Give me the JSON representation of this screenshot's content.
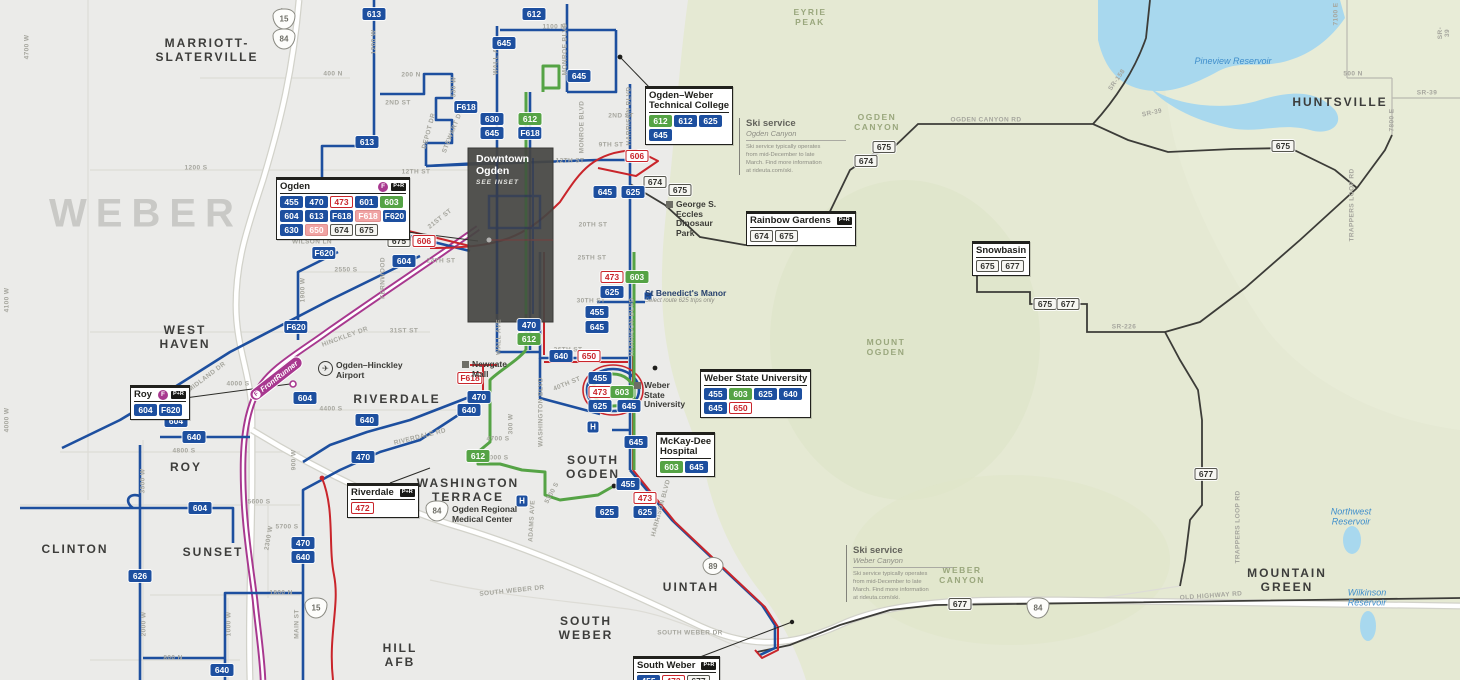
{
  "map_title": "UTA Ogden area bus routes map",
  "colors": {
    "route_blue": "#1d4f9f",
    "route_green": "#55a345",
    "route_red": "#c9252b",
    "route_pink": "#f0a3a3",
    "mountain_road": "#3c3c38",
    "frontrunner": "#a8388f",
    "terrain_green": "#e6ead5",
    "water": "#a8d8ee",
    "urban": "#ebebe9"
  },
  "inset": {
    "title": "Downtown\nOgden",
    "note": "SEE INSET"
  },
  "area_labels": [
    [
      "MARRIOTT-\nSLATERVILLE",
      207,
      51
    ],
    [
      "WEST\nHAVEN",
      185,
      338
    ],
    [
      "RIVERDALE",
      397,
      400
    ],
    [
      "ROY",
      186,
      468
    ],
    [
      "CLINTON",
      75,
      550
    ],
    [
      "SUNSET",
      213,
      553
    ],
    [
      "WASHINGTON\nTERRACE",
      468,
      491
    ],
    [
      "SOUTH\nOGDEN",
      593,
      468
    ],
    [
      "UINTAH",
      691,
      588
    ],
    [
      "SOUTH\nWEBER",
      586,
      629
    ],
    [
      "HILL\nAFB",
      400,
      656
    ],
    [
      "HUNTSVILLE",
      1340,
      103
    ],
    [
      "MOUNTAIN\nGREEN",
      1287,
      581
    ]
  ],
  "county_label": [
    "WEBER",
    146,
    214
  ],
  "green_area_labels": [
    [
      "EYRIE\nPEAK",
      810,
      17
    ],
    [
      "OGDEN\nCANYON",
      877,
      122
    ],
    [
      "MOUNT\nOGDEN",
      886,
      347
    ],
    [
      "WEBER\nCANYON",
      962,
      575
    ]
  ],
  "water_labels": [
    [
      "Pineview Reservoir",
      1233,
      61
    ],
    [
      "Northwest\nReservoir",
      1351,
      517
    ],
    [
      "Wilkinson\nReservoir",
      1367,
      598
    ]
  ],
  "street_labels": [
    [
      "1100 N",
      554,
      27,
      0
    ],
    [
      "400 N",
      333,
      74,
      0
    ],
    [
      "200 N",
      411,
      75,
      0
    ],
    [
      "2ND ST",
      398,
      103,
      0
    ],
    [
      "2ND ST",
      621,
      116,
      0
    ],
    [
      "9TH ST",
      611,
      145,
      0
    ],
    [
      "12TH ST",
      416,
      172,
      0
    ],
    [
      "12TH ST",
      570,
      161,
      0
    ],
    [
      "1200 S",
      196,
      168,
      0
    ],
    [
      "20TH ST",
      593,
      225,
      0
    ],
    [
      "WILSON LN",
      312,
      242,
      0
    ],
    [
      "21ST ST",
      440,
      219,
      -38
    ],
    [
      "24TH ST",
      441,
      261,
      0
    ],
    [
      "25TH ST",
      592,
      258,
      0
    ],
    [
      "2550 S",
      346,
      270,
      0
    ],
    [
      "30TH ST",
      591,
      301,
      0
    ],
    [
      "31ST ST",
      404,
      331,
      0
    ],
    [
      "HINCKLEY DR",
      345,
      337,
      -20
    ],
    [
      "36TH ST",
      568,
      350,
      0
    ],
    [
      "40TH ST",
      567,
      384,
      -22
    ],
    [
      "MIDLAND DR",
      207,
      377,
      -37
    ],
    [
      "4000 S",
      238,
      384,
      0
    ],
    [
      "4400 S",
      331,
      409,
      0
    ],
    [
      "RIVERDALE RD",
      420,
      437,
      -14
    ],
    [
      "4700 S",
      498,
      439,
      0
    ],
    [
      "5000 S",
      497,
      458,
      0
    ],
    [
      "5300 S",
      552,
      493,
      -62
    ],
    [
      "4800 S",
      184,
      451,
      0
    ],
    [
      "5600 S",
      259,
      502,
      0
    ],
    [
      "5700 S",
      287,
      527,
      0
    ],
    [
      "1800 N",
      281,
      593,
      0
    ],
    [
      "800 N",
      173,
      658,
      0
    ],
    [
      "SOUTH WEBER DR",
      512,
      591,
      -6
    ],
    [
      "SOUTH WEBER DR",
      690,
      633,
      0
    ],
    [
      "OLD HIGHWAY RD",
      1211,
      596,
      -4
    ],
    [
      "OGDEN CANYON RD",
      986,
      120,
      0
    ],
    [
      "SR-39",
      1152,
      113,
      -12
    ],
    [
      "SR-226",
      1124,
      327,
      0
    ],
    [
      "500 N",
      1353,
      74,
      0
    ],
    [
      "SR-39",
      1427,
      93,
      0
    ],
    [
      "4700 W",
      27,
      47,
      -90
    ],
    [
      "4100 W",
      7,
      300,
      -90
    ],
    [
      "4000 W",
      7,
      420,
      -90
    ],
    [
      "2000 W",
      284,
      20,
      -90
    ],
    [
      "1200 W",
      374,
      42,
      -90
    ],
    [
      "530 W",
      454,
      87,
      -90
    ],
    [
      "WALL AVE",
      496,
      57,
      -90
    ],
    [
      "WALL AVE",
      499,
      337,
      -90
    ],
    [
      "MONROE BLVD",
      565,
      49,
      -90
    ],
    [
      "MONROE BLVD",
      582,
      127,
      -90
    ],
    [
      "HARRISON BLVD",
      629,
      116,
      -90
    ],
    [
      "HARRISON BLVD",
      632,
      327,
      -90
    ],
    [
      "HARRISON BLVD",
      661,
      508,
      -75
    ],
    [
      "WASHINGTON BLVD",
      541,
      412,
      -90
    ],
    [
      "300 W",
      511,
      424,
      -90
    ],
    [
      "ADAMS AVE",
      532,
      521,
      -87
    ],
    [
      "DEPOT DR",
      429,
      131,
      -75
    ],
    [
      "STEWART DR",
      453,
      131,
      -68
    ],
    [
      "FERNWOOD",
      383,
      278,
      -90
    ],
    [
      "1900 W",
      303,
      290,
      -90
    ],
    [
      "900 W",
      294,
      460,
      -90
    ],
    [
      "3500 W",
      143,
      481,
      -90
    ],
    [
      "2300 W",
      269,
      538,
      -80
    ],
    [
      "2000 W",
      144,
      624,
      -90
    ],
    [
      "1000 W",
      229,
      624,
      -90
    ],
    [
      "MAIN ST",
      297,
      624,
      -90
    ],
    [
      "7100 E",
      1336,
      14,
      -90
    ],
    [
      "7800 E",
      1392,
      120,
      -90
    ],
    [
      "SR-158",
      1117,
      80,
      -55
    ],
    [
      "TRAPPERS LOOP RD",
      1352,
      205,
      -90
    ],
    [
      "TRAPPERS LOOP RD",
      1238,
      527,
      -90
    ],
    [
      "SR-39",
      1444,
      33,
      -90
    ]
  ],
  "badges": [
    [
      374,
      14,
      "613",
      "b"
    ],
    [
      534,
      14,
      "612",
      "b"
    ],
    [
      504,
      43,
      "645",
      "b"
    ],
    [
      579,
      76,
      "645",
      "b"
    ],
    [
      466,
      107,
      "F618",
      "b"
    ],
    [
      492,
      119,
      "630",
      "b"
    ],
    [
      492,
      133,
      "645",
      "b"
    ],
    [
      530,
      119,
      "612",
      "g"
    ],
    [
      530,
      133,
      "F618",
      "b"
    ],
    [
      367,
      142,
      "613",
      "b"
    ],
    [
      637,
      156,
      "606",
      "r"
    ],
    [
      655,
      182,
      "674",
      "gy"
    ],
    [
      680,
      190,
      "675",
      "gy"
    ],
    [
      605,
      192,
      "645",
      "b"
    ],
    [
      633,
      192,
      "625",
      "b"
    ],
    [
      399,
      241,
      "675",
      "gy"
    ],
    [
      424,
      241,
      "606",
      "r"
    ],
    [
      324,
      253,
      "F620",
      "b"
    ],
    [
      404,
      261,
      "604",
      "b"
    ],
    [
      612,
      277,
      "473",
      "r"
    ],
    [
      637,
      277,
      "603",
      "g"
    ],
    [
      612,
      292,
      "625",
      "b"
    ],
    [
      597,
      312,
      "455",
      "b"
    ],
    [
      597,
      327,
      "645",
      "b"
    ],
    [
      296,
      327,
      "F620",
      "b"
    ],
    [
      529,
      325,
      "470",
      "b"
    ],
    [
      529,
      339,
      "612",
      "g"
    ],
    [
      470,
      378,
      "F618",
      "r"
    ],
    [
      561,
      356,
      "640",
      "b"
    ],
    [
      589,
      356,
      "650",
      "r"
    ],
    [
      305,
      398,
      "604",
      "b"
    ],
    [
      176,
      421,
      "604",
      "b"
    ],
    [
      367,
      420,
      "640",
      "b"
    ],
    [
      194,
      437,
      "640",
      "b"
    ],
    [
      479,
      397,
      "470",
      "b"
    ],
    [
      469,
      410,
      "640",
      "b"
    ],
    [
      363,
      457,
      "470",
      "b"
    ],
    [
      478,
      456,
      "612",
      "g"
    ],
    [
      600,
      378,
      "455",
      "b"
    ],
    [
      600,
      392,
      "473",
      "r"
    ],
    [
      622,
      392,
      "603",
      "g"
    ],
    [
      600,
      406,
      "625",
      "b"
    ],
    [
      629,
      406,
      "645",
      "b"
    ],
    [
      636,
      442,
      "645",
      "b"
    ],
    [
      628,
      484,
      "455",
      "b"
    ],
    [
      645,
      498,
      "473",
      "r"
    ],
    [
      607,
      512,
      "625",
      "b"
    ],
    [
      645,
      512,
      "625",
      "b"
    ],
    [
      200,
      508,
      "604",
      "b"
    ],
    [
      303,
      543,
      "470",
      "b"
    ],
    [
      303,
      557,
      "640",
      "b"
    ],
    [
      140,
      576,
      "626",
      "b"
    ],
    [
      222,
      670,
      "640",
      "b"
    ],
    [
      884,
      147,
      "675",
      "gy"
    ],
    [
      866,
      161,
      "674",
      "gy"
    ],
    [
      1283,
      146,
      "675",
      "gy"
    ],
    [
      1045,
      304,
      "675",
      "gy"
    ],
    [
      1068,
      304,
      "677",
      "gy"
    ],
    [
      1206,
      474,
      "677",
      "gy"
    ],
    [
      960,
      604,
      "677",
      "gy"
    ]
  ],
  "shields": [
    [
      "15",
      "i",
      284,
      19
    ],
    [
      "84",
      "i",
      284,
      39
    ],
    [
      "84",
      "i",
      437,
      511
    ],
    [
      "15",
      "i",
      316,
      608
    ],
    [
      "84",
      "i",
      1038,
      608
    ],
    [
      "89",
      "u",
      713,
      566
    ]
  ],
  "boxes": [
    {
      "id": "ogden",
      "x": 276,
      "y": 177,
      "title": "Ogden",
      "icons": [
        "fr",
        "pr"
      ],
      "rows": [
        [
          [
            "455",
            "b"
          ],
          [
            "470",
            "b"
          ],
          [
            "473",
            "r"
          ],
          [
            "601",
            "b"
          ],
          [
            "603",
            "g"
          ]
        ],
        [
          [
            "604",
            "b"
          ],
          [
            "613",
            "b"
          ],
          [
            "F618",
            "b"
          ],
          [
            "F618",
            "p"
          ],
          [
            "F620",
            "b"
          ]
        ],
        [
          [
            "630",
            "b"
          ],
          [
            "650",
            "p"
          ],
          [
            "674",
            "gy"
          ],
          [
            "675",
            "gy"
          ]
        ]
      ]
    },
    {
      "id": "owtc",
      "x": 645,
      "y": 86,
      "title": "Ogden–Weber\nTechnical College",
      "icons": [],
      "rows": [
        [
          [
            "612",
            "g"
          ],
          [
            "612",
            "b"
          ],
          [
            "625",
            "b"
          ]
        ],
        [
          [
            "645",
            "b"
          ]
        ]
      ]
    },
    {
      "id": "rainbow-gardens",
      "x": 746,
      "y": 211,
      "title": "Rainbow Gardens",
      "icons": [
        "pr"
      ],
      "rows": [
        [
          [
            "674",
            "gy"
          ],
          [
            "675",
            "gy"
          ]
        ]
      ]
    },
    {
      "id": "snowbasin",
      "x": 972,
      "y": 241,
      "title": "Snowbasin",
      "icons": [],
      "rows": [
        [
          [
            "675",
            "gy"
          ],
          [
            "677",
            "gy"
          ]
        ]
      ]
    },
    {
      "id": "wsu",
      "x": 700,
      "y": 369,
      "title": "Weber State University",
      "icons": [],
      "rows": [
        [
          [
            "455",
            "b"
          ],
          [
            "603",
            "g"
          ],
          [
            "625",
            "b"
          ],
          [
            "640",
            "b"
          ]
        ],
        [
          [
            "645",
            "b"
          ],
          [
            "650",
            "r"
          ]
        ]
      ]
    },
    {
      "id": "mckay-dee",
      "x": 656,
      "y": 432,
      "title": "McKay-Dee\nHospital",
      "icons": [],
      "rows": [
        [
          [
            "603",
            "g"
          ],
          [
            "645",
            "b"
          ]
        ]
      ]
    },
    {
      "id": "roy",
      "x": 130,
      "y": 385,
      "title": "Roy",
      "icons": [
        "fr",
        "pr"
      ],
      "rows": [
        [
          [
            "604",
            "b"
          ],
          [
            "F620",
            "b"
          ]
        ]
      ]
    },
    {
      "id": "riverdale",
      "x": 347,
      "y": 483,
      "title": "Riverdale",
      "icons": [
        "pr"
      ],
      "rows": [
        [
          [
            "472",
            "r"
          ]
        ]
      ]
    },
    {
      "id": "south-weber",
      "x": 633,
      "y": 656,
      "title": "South Weber",
      "icons": [
        "pr"
      ],
      "rows": [
        [
          [
            "455",
            "b"
          ],
          [
            "473",
            "r"
          ],
          [
            "677",
            "gy"
          ]
        ]
      ]
    }
  ],
  "pois": [
    {
      "type": "manor",
      "x": 645,
      "y": 288,
      "label": "St Benedict's Manor",
      "sub": "Select route 625 trips only"
    },
    {
      "type": "airport",
      "x": 318,
      "y": 361,
      "label": "Ogden–Hinckley\nAirport"
    },
    {
      "type": "mall",
      "x": 462,
      "y": 360,
      "label": "Newgate\nMall"
    },
    {
      "type": "dino",
      "x": 666,
      "y": 200,
      "label": "George S.\nEccles\nDinosaur\nPark"
    },
    {
      "type": "campus",
      "x": 634,
      "y": 381,
      "label": "Weber\nState\nUniversity"
    },
    {
      "type": "medcenter",
      "x": 452,
      "y": 505,
      "label": "Ogden Regional\nMedical Center"
    },
    {
      "type": "fr-label",
      "x": 244,
      "y": 372,
      "rot": -38,
      "label": "FrontRunner"
    }
  ],
  "hospital_icons": [
    [
      593,
      427
    ],
    [
      522,
      501
    ]
  ],
  "ski_notes": [
    {
      "x": 739,
      "y": 118,
      "title": "Ski service",
      "sub": "Ogden Canyon",
      "body": "Ski service typically operates from mid-December to late March. Find more information at rideuta.com/ski."
    },
    {
      "x": 846,
      "y": 545,
      "title": "Ski service",
      "sub": "Weber Canyon",
      "body": "Ski service typically operates from mid-December to late March. Find more information at rideuta.com/ski."
    }
  ]
}
